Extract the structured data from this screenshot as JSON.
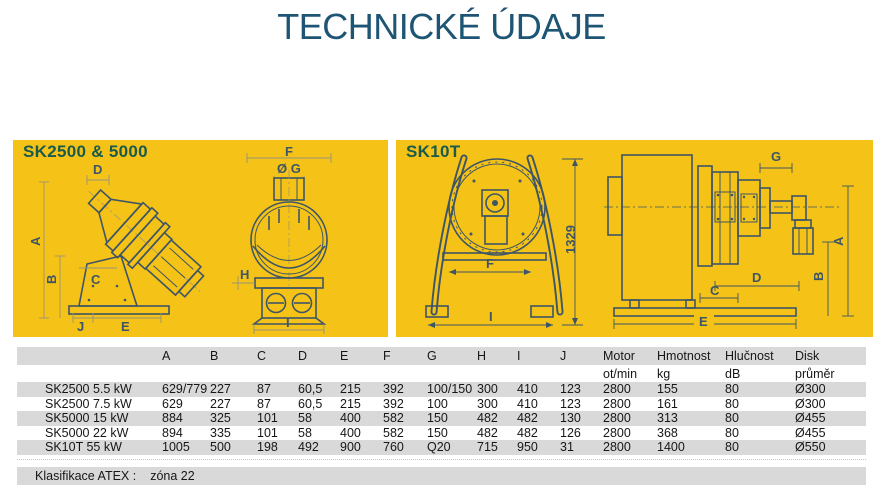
{
  "page": {
    "title": "TECHNICKÉ ÚDAJE"
  },
  "colors": {
    "panel_yellow": "#f5c317",
    "panel_title_green": "#195a4c",
    "page_title_blue": "#1e5574",
    "drawing_line": "#3e5566",
    "table_stripe_gray": "#d9d9d9"
  },
  "panels": {
    "left": {
      "title": "SK2500 & 5000",
      "side_dims": {
        "d": "D",
        "a": "A",
        "b": "B",
        "c": "C",
        "j": "J",
        "e": "E"
      },
      "front_dims": {
        "f": "F",
        "g": "Ø G",
        "h": "H",
        "i": "I"
      }
    },
    "right": {
      "title": "SK10T",
      "front_dims": {
        "f": "F",
        "i": "I",
        "height": "1329"
      },
      "side_dims": {
        "g": "G",
        "a": "A",
        "b": "B",
        "c": "C",
        "d": "D",
        "e": "E"
      }
    }
  },
  "table": {
    "header": [
      "A",
      "B",
      "C",
      "D",
      "E",
      "F",
      "G",
      "H",
      "I",
      "J",
      "Motor",
      "Hmotnost",
      "Hlučnost",
      "Disk"
    ],
    "units": [
      "",
      "",
      "",
      "",
      "",
      "",
      "",
      "",
      "",
      "",
      "ot/min",
      "kg",
      "dB",
      "průměr"
    ],
    "rows": [
      {
        "name": "SK2500 5.5 kW",
        "values": [
          "629/779",
          "227",
          "87",
          "60,5",
          "215",
          "392",
          "100/150",
          "300",
          "410",
          "123",
          "2800",
          "155",
          "80",
          "Ø300"
        ]
      },
      {
        "name": "SK2500 7.5 kW",
        "values": [
          "629",
          "227",
          "87",
          "60,5",
          "215",
          "392",
          "100",
          "300",
          "410",
          "123",
          "2800",
          "161",
          "80",
          "Ø300"
        ]
      },
      {
        "name": "SK5000 15 kW",
        "values": [
          "884",
          "325",
          "101",
          "58",
          "400",
          "582",
          "150",
          "482",
          "482",
          "130",
          "2800",
          "313",
          "80",
          "Ø455"
        ]
      },
      {
        "name": "SK5000 22 kW",
        "values": [
          "894",
          "335",
          "101",
          "58",
          "400",
          "582",
          "150",
          "482",
          "482",
          "126",
          "2800",
          "368",
          "80",
          "Ø455"
        ]
      },
      {
        "name": "SK10T 55 kW",
        "values": [
          "1005",
          "500",
          "198",
          "492",
          "900",
          "760",
          "Q20",
          "715",
          "950",
          "31",
          "2800",
          "1400",
          "80",
          "Ø550"
        ]
      }
    ]
  },
  "footer": {
    "label": "Klasifikace ATEX :",
    "value": "zóna 22"
  }
}
